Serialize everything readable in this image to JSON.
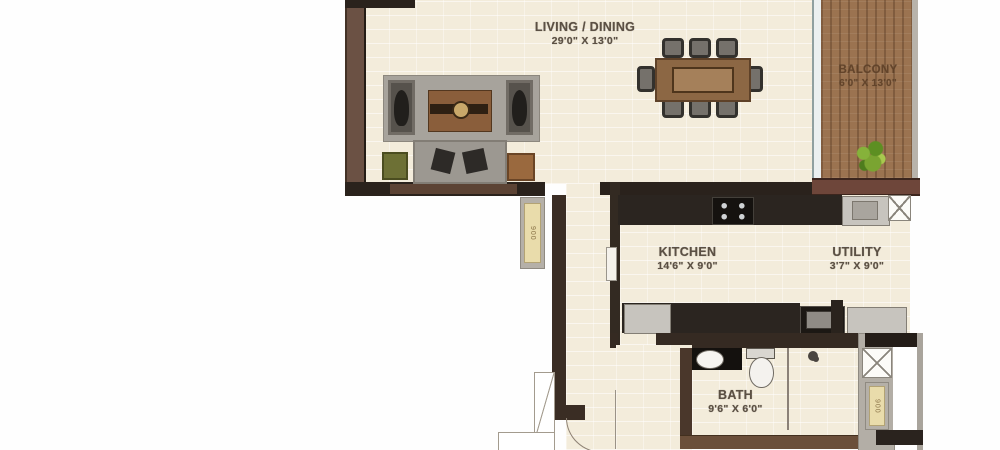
{
  "plan_title": "apartment-floor-plan",
  "rooms": {
    "living": {
      "name": "LIVING / DINING",
      "size": "29'0\" X 13'0\""
    },
    "balcony": {
      "name": "BALCONY",
      "size": "6'0\" X 13'0\""
    },
    "kitchen": {
      "name": "KITCHEN",
      "size": "14'6\" X 9'0\""
    },
    "utility": {
      "name": "UTILITY",
      "size": "3'7\" X 9'0\""
    },
    "bath": {
      "name": "BATH",
      "size": "9'6\" X 6'0\""
    }
  },
  "doors": {
    "corridor_tag": "900",
    "bath_tag": "900"
  },
  "colors": {
    "floor": "#f3ecdb",
    "wall_dark": "#2a221c",
    "wall_brown": "#6b5144",
    "balcony_wall": "#6e463a",
    "balcony_floor": "#9b7350",
    "counter": "#2b2520",
    "appliance_gray": "#c7c4be",
    "label_text": "#5b5044",
    "plant_green": "#7aa431",
    "door_tag_fill": "#e9dcab",
    "glass_partition": "#8fa0a0"
  }
}
